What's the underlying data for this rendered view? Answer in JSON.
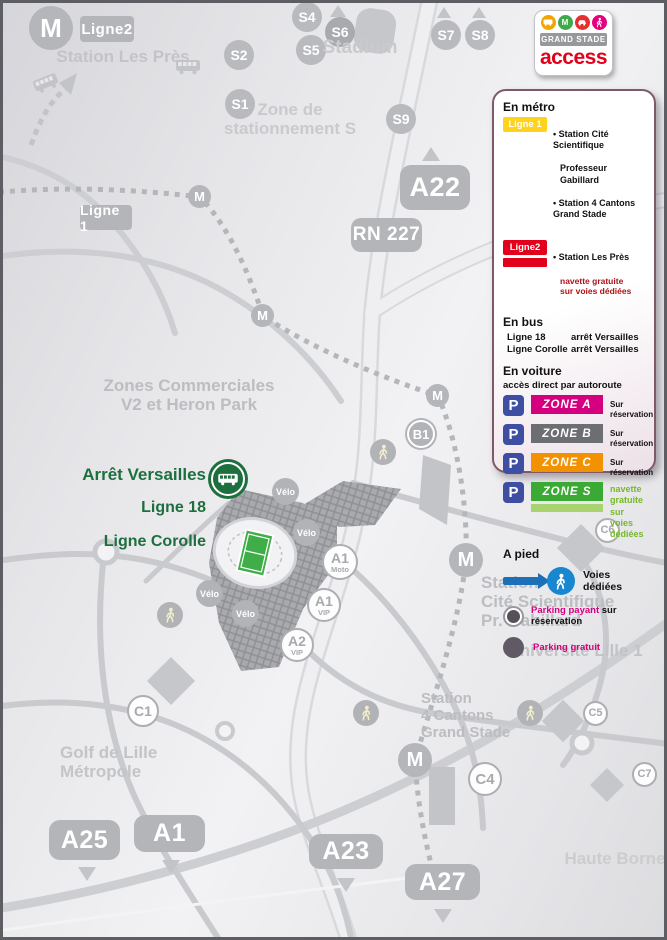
{
  "logo": {
    "grand_stade": "GRAND STADE",
    "access": "access",
    "icons": [
      "bus-icon",
      "metro-icon",
      "car-icon",
      "pedestrian-icon"
    ]
  },
  "legend": {
    "metro_heading": "En métro",
    "ligne1_badge": "Ligne 1",
    "ligne1_station1a": "• Station Cité Scientifique",
    "ligne1_station1b": "Professeur Gabillard",
    "ligne1_station2": "• Station 4 Cantons Grand Stade",
    "ligne2_badge": "Ligne2",
    "ligne2_station": "• Station Les Près",
    "ligne2_note": "navette gratuite\nsur voies dédiées",
    "bus_heading": "En bus",
    "bus_rows": [
      {
        "line": "Ligne 18",
        "stop": "arrêt Versailles"
      },
      {
        "line": "Ligne Corolle",
        "stop": "arrêt Versailles"
      }
    ],
    "car_heading": "En voiture",
    "car_sub": "accès direct par autoroute",
    "p_letter": "P",
    "zones": [
      {
        "label": "ZONE  A",
        "color": "#d5007f",
        "note": "Sur réservation"
      },
      {
        "label": "ZONE  B",
        "color": "#6d6e71",
        "note": "Sur réservation"
      },
      {
        "label": "ZONE  C",
        "color": "#f39200",
        "note": "Sur réservation"
      },
      {
        "label": "ZONE  S",
        "color": "#3aaa35",
        "note": "navette gratuite\nsur voies dédiées"
      }
    ],
    "walk_heading": "A pied",
    "walk_note": "Voies dédiées",
    "parking_paid_label": "Parking payant",
    "parking_paid_suffix": " sur réservation",
    "parking_free_label": "Parking gratuit"
  },
  "map": {
    "road_labels": {
      "ligne2": "Ligne2",
      "ligne1": "Ligne 1",
      "a22": "A22",
      "rn227": "RN 227",
      "a25": "A25",
      "a1": "A1",
      "a23": "A23",
      "a27": "A27"
    },
    "s_markers": [
      "S4",
      "S6",
      "S5",
      "S2",
      "S1",
      "S7",
      "S8",
      "S9"
    ],
    "c_markers": [
      "C1",
      "C4",
      "C5",
      "C6",
      "C7"
    ],
    "zone_circles": [
      {
        "big": "A1",
        "small": "Moto"
      },
      {
        "big": "A1",
        "small": "VIP"
      },
      {
        "big": "A2",
        "small": "VIP"
      }
    ],
    "b1": "B1",
    "m": "M",
    "velo": "Vélo",
    "stop": {
      "line1": "Arrêt Versailles",
      "line2": "Ligne 18",
      "line3": "Ligne Corolle"
    },
    "areas": {
      "les_pres": "Station Les Près",
      "stadium": "Stadium",
      "zone_s": "Zone de\nstationnement S",
      "commerciales": "Zones Commerciales\nV2 et Heron Park",
      "cite": "Station\nCité Scientifique\nPr. Gabillard",
      "universite": "Université Lille 1",
      "cantons": "Station\n4 Cantons\nGrand Stade",
      "golf": "Golf de Lille\nMétropole",
      "haute_borne": "Haute Borne"
    },
    "colors": {
      "pitch_green": "#3fae49",
      "stop_pin_green": "#1d6f3e",
      "marker_gray": "#b2b3b7",
      "walk_blue": "#1787cf"
    }
  }
}
